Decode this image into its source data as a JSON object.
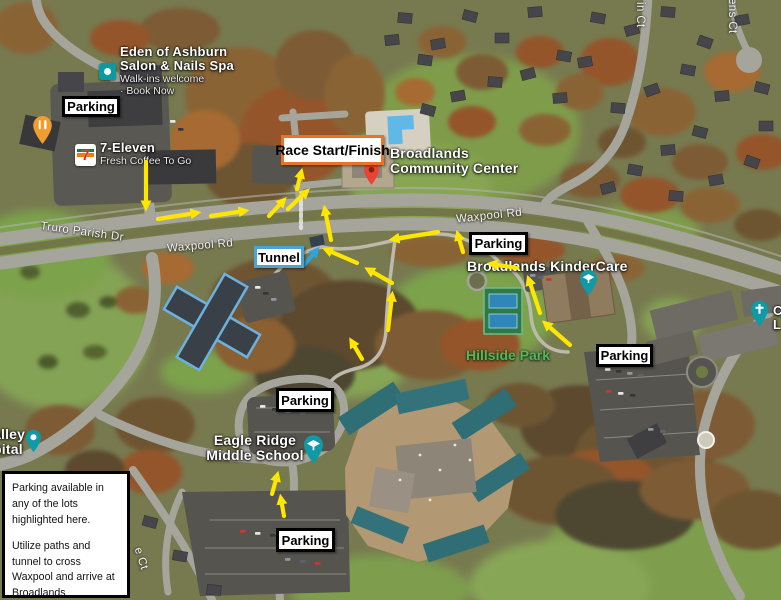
{
  "annotations": {
    "parking": "Parking",
    "race_start_finish": "Race Start/Finish",
    "tunnel": "Tunnel"
  },
  "info_box": {
    "para1": "Parking available in any of the lots highlighted here.",
    "para2": "Utilize paths and tunnel to cross Waxpool and arrive at Broadlands Community Center."
  },
  "map_labels": {
    "eden_line1": "Eden of Ashburn",
    "eden_line2": "Salon & Nails Spa",
    "eden_sub1": "Walk-ins welcome",
    "eden_sub2": "· Book Now",
    "seven_eleven_name": "7-Eleven",
    "seven_eleven_sub": "Fresh Coffee To Go",
    "seven_eleven_logo_char": "7",
    "community_center_line1": "Broadlands",
    "community_center_line2": "Community Center",
    "kindercare": "Broadlands KinderCare",
    "hillside_park": "Hillside Park",
    "school_line1": "Eagle Ridge",
    "school_line2": "Middle School",
    "hospital_line1": "alley",
    "hospital_line2": "pital",
    "church_frag_line1": "C",
    "church_frag_line2": "L",
    "road_waxpool_west": "Waxpool Rd",
    "road_waxpool_east": "Waxpool Rd",
    "road_truro": "Truro Parish Dr",
    "road_ct_top_left": "in Ct",
    "road_ct_top_right": "ens Ct",
    "road_ct_bottom": "e Ct"
  },
  "icons": {
    "race_pin": "red-map-pin",
    "restaurant_pin": "orange-restaurant-pin",
    "spa_icon": "teal-square-place-icon",
    "hospital_pin": "teal-map-pin",
    "kindercare_pin": "teal-graduation-pin",
    "school_pin": "teal-graduation-pin",
    "church_pin": "teal-church-pin",
    "seven_eleven_logo": "7-eleven-logo"
  },
  "colors": {
    "route_arrow": "#ffe600",
    "tunnel_arrow": "#2fa3dd",
    "race_box_border": "#e8732a",
    "tunnel_box_border": "#4ba3db",
    "parking_box_border": "#000000",
    "park_label_green": "#54b65e"
  }
}
